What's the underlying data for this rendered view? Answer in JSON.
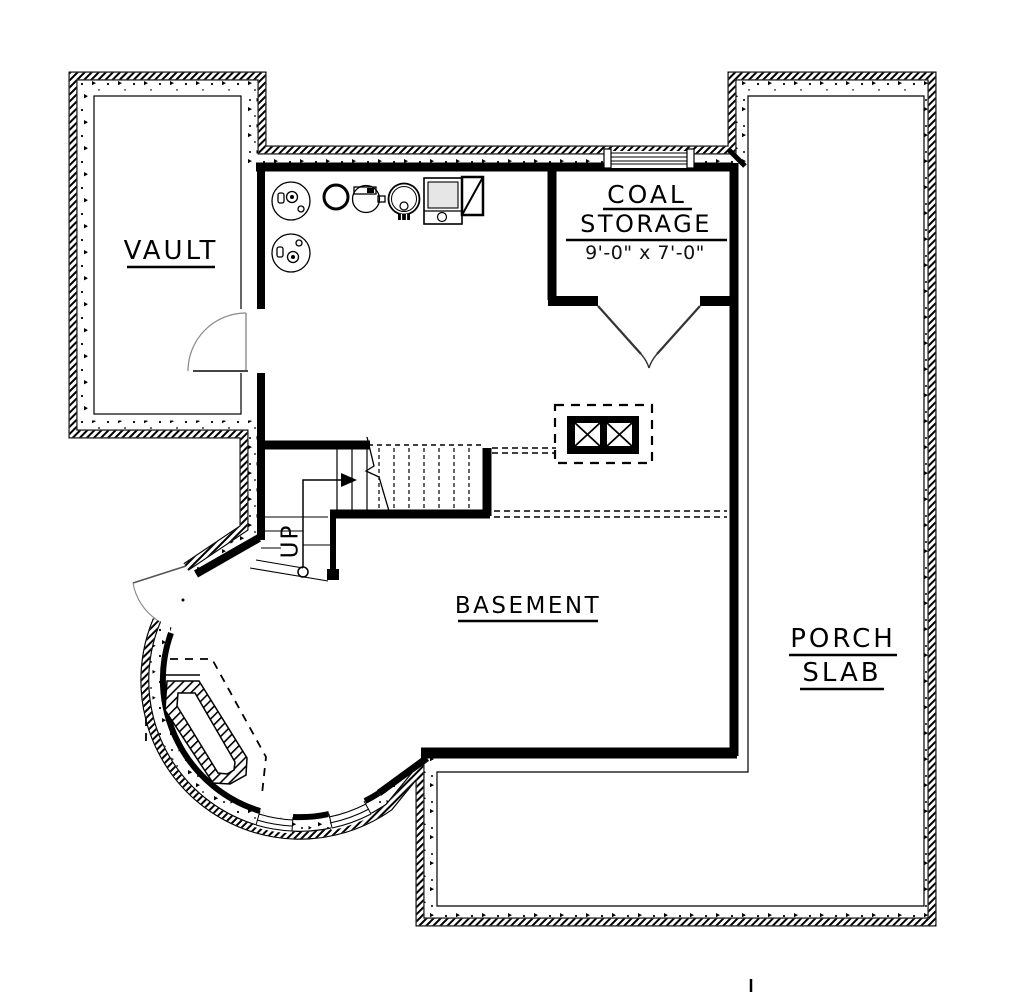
{
  "drawing": {
    "type": "basement floor plan",
    "labels": {
      "vault": "VAULT",
      "coal_line1": "COAL",
      "coal_line2": "STORAGE",
      "coal_dims": "9'-0\" x 7'-0\"",
      "basement": "BASEMENT",
      "porch_line1": "PORCH",
      "porch_line2": "SLAB",
      "stairs_up": "UP"
    },
    "colors": {
      "ink": "#000000",
      "paper": "#ffffff"
    },
    "symbols": [
      "floor-drain",
      "floor-drain",
      "pressure-tank",
      "water-softener",
      "water-heater",
      "furnace",
      "air-plenum",
      "chimney-flues"
    ]
  }
}
